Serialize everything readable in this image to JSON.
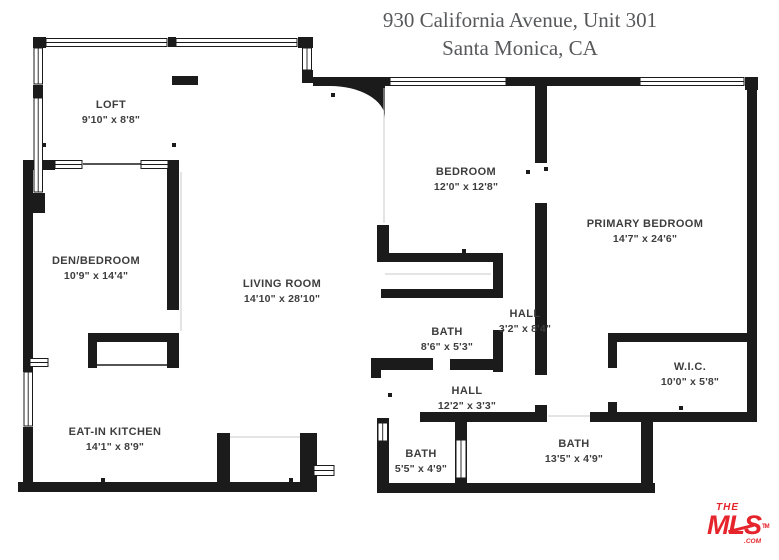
{
  "title": {
    "line1": "930 California Avenue, Unit 301",
    "line2": "Santa Monica, CA"
  },
  "rooms": [
    {
      "id": "loft",
      "name": "LOFT",
      "dims": "9'10\" x 8'8\""
    },
    {
      "id": "den-bedroom",
      "name": "DEN/BEDROOM",
      "dims": "10'9\" x 14'4\""
    },
    {
      "id": "living-room",
      "name": "LIVING ROOM",
      "dims": "14'10\" x 28'10\""
    },
    {
      "id": "bedroom",
      "name": "BEDROOM",
      "dims": "12'0\" x 12'8\""
    },
    {
      "id": "primary-bedroom",
      "name": "PRIMARY BEDROOM",
      "dims": "14'7\" x 24'6\""
    },
    {
      "id": "bath-main",
      "name": "BATH",
      "dims": "8'6\" x 5'3\""
    },
    {
      "id": "hall-upper",
      "name": "HALL",
      "dims": "3'2\" x 8'4\""
    },
    {
      "id": "wic",
      "name": "W.I.C.",
      "dims": "10'0\" x 5'8\""
    },
    {
      "id": "hall-lower",
      "name": "HALL",
      "dims": "12'2\" x 3'3\""
    },
    {
      "id": "eat-in-kitchen",
      "name": "EAT-IN KITCHEN",
      "dims": "14'1\" x 8'9\""
    },
    {
      "id": "bath-small",
      "name": "BATH",
      "dims": "5'5\" x 4'9\""
    },
    {
      "id": "bath-long",
      "name": "BATH",
      "dims": "13'5\" x 4'9\""
    }
  ],
  "logo": {
    "the": "THE",
    "mls": "MLS",
    "tm": "TM",
    "com": ".COM"
  },
  "colors": {
    "wall": "#1b1b1b",
    "label_text": "#3d3d3d",
    "title_text": "#57585a",
    "logo_red": "#e5242c",
    "background": "#ffffff"
  }
}
